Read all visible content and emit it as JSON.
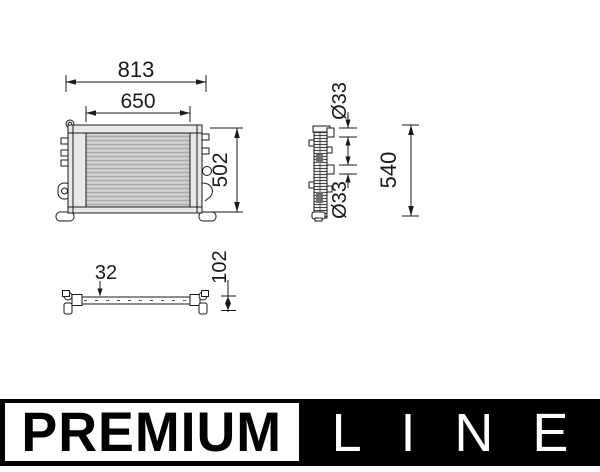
{
  "drawing": {
    "front_view": {
      "dim_overall_width": "813",
      "dim_core_width": "650",
      "dim_height": "502"
    },
    "side_view": {
      "dim_pipe_top_diameter": "Ø33",
      "dim_pipe_bottom_diameter": "Ø33",
      "dim_overall_height": "540"
    },
    "bottom_view": {
      "dim_depth": "32",
      "dim_mount_height": "102"
    }
  },
  "logo": {
    "premium_label": "PREMIUM",
    "line_label": "LINE"
  },
  "colors": {
    "line_art": "#1a1a1a",
    "core_fill": "#c6c6c6",
    "logo_background": "#000000",
    "logo_text": "#ffffff"
  }
}
